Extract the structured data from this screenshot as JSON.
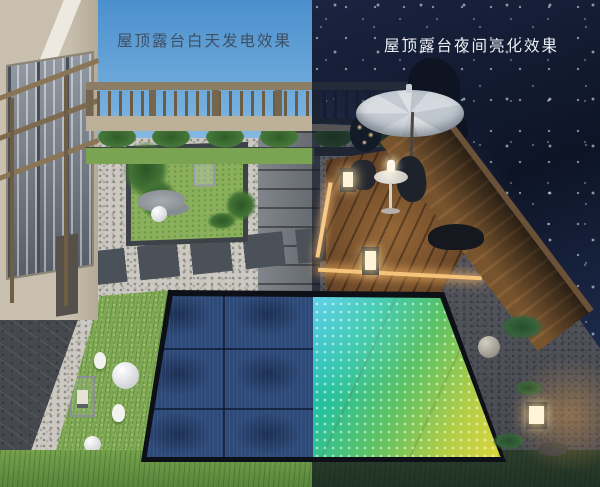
{
  "image": {
    "width": 600,
    "height": 487,
    "description": "3D rendering of a rooftop terrace split vertically: left half daytime with dark-blue solar panel floor, right half nighttime with glowing color LED floor"
  },
  "captions": {
    "day": "屋顶露台白天发电效果",
    "night": "屋顶露台夜间亮化效果"
  },
  "palette": {
    "day_sky": "#4b90cd",
    "night_sky": "#0f1628",
    "solar_panel_blue": "#2e4a78",
    "led_cyan": "#12b2d6",
    "led_green": "#5fc262",
    "led_yellow": "#e8da38",
    "pebble": "#ccc9c2",
    "grass": "#7fa854",
    "paving_grey": "#70757b",
    "stone_platform": "#45494e",
    "building_wall": "#c9bfae",
    "railing_wood": "#77664e",
    "deck_wood": "#5e3e24",
    "umbrella_grey": "#d2d7dd",
    "lantern_glow": "#fff3d8",
    "warm_edge_light": "#f5c37a",
    "caption_day_color": "#3f4f63",
    "caption_night_color": "#edf0f5"
  },
  "objects": {
    "left_day_side": [
      "building facade with windows and pergola frame",
      "wood railing with balusters",
      "shrub planter row",
      "garden bed with ferns, rocks, white sphere and chair sculpture",
      "grey paving slabs",
      "white pebble paths",
      "dark stone platform with steps",
      "grass strip with rabbit sculptures, spheres and frame lamp",
      "dark blue solar panel floor with black frame"
    ],
    "right_night_side": [
      "starry night sky",
      "patio umbrella",
      "round side table with small lamp",
      "outdoor chairs",
      "wood deck with warm edge lighting",
      "glowing cube lanterns",
      "wood privacy fence lit from below",
      "gravel garden with plants, stone sphere and rocks",
      "LED floor glowing cyan to green to yellow"
    ]
  }
}
